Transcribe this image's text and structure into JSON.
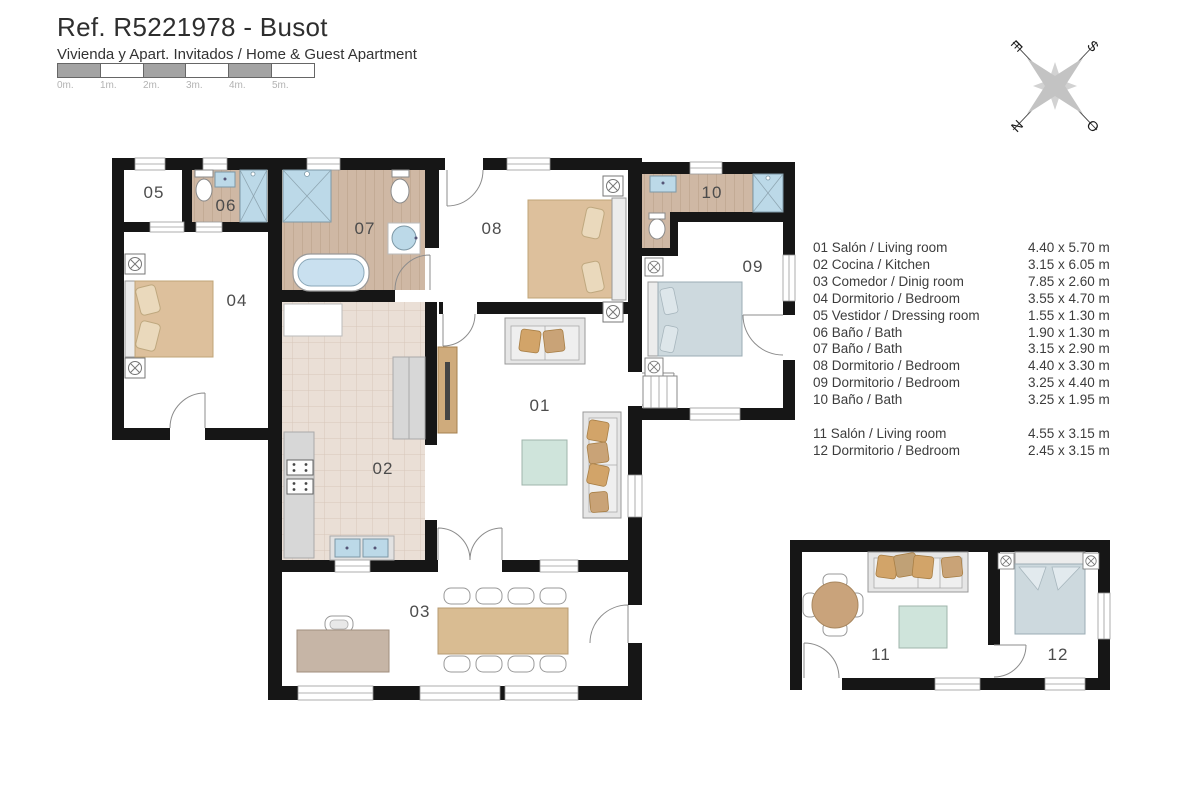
{
  "header": {
    "title": "Ref. R5221978 - Busot",
    "subtitle": "Vivienda y Apart. Invitados / Home & Guest Apartment"
  },
  "scale_bar": {
    "labels": [
      "0m.",
      "1m.",
      "2m.",
      "3m.",
      "4m.",
      "5m."
    ]
  },
  "compass": {
    "north": "N",
    "south": "S",
    "east": "E",
    "west": "O"
  },
  "legend": {
    "main_rows": [
      {
        "label": "01 Salón / Living room",
        "size": "4.40 x 5.70 m"
      },
      {
        "label": "02 Cocina / Kitchen",
        "size": "3.15 x 6.05 m"
      },
      {
        "label": "03 Comedor / Dinig room",
        "size": "7.85 x 2.60 m"
      },
      {
        "label": "04 Dormitorio / Bedroom",
        "size": "3.55 x 4.70 m"
      },
      {
        "label": "05 Vestidor / Dressing room",
        "size": "1.55 x 1.30 m"
      },
      {
        "label": "06 Baño / Bath",
        "size": "1.90 x 1.30 m"
      },
      {
        "label": "07 Baño / Bath",
        "size": "3.15 x 2.90 m"
      },
      {
        "label": "08 Dormitorio / Bedroom",
        "size": "4.40 x 3.30 m"
      },
      {
        "label": "09 Dormitorio / Bedroom",
        "size": "3.25 x 4.40 m"
      },
      {
        "label": "10 Baño / Bath",
        "size": "3.25 x 1.95 m"
      }
    ],
    "guest_rows": [
      {
        "label": "11 Salón / Living room",
        "size": "4.55 x 3.15 m"
      },
      {
        "label": "12 Dormitorio / Bedroom",
        "size": "2.45 x 3.15 m"
      }
    ]
  },
  "plan": {
    "room_labels": {
      "r01": "01",
      "r02": "02",
      "r03": "03",
      "r04": "04",
      "r05": "05",
      "r06": "06",
      "r07": "07",
      "r08": "08",
      "r09": "09",
      "r10": "10",
      "r11": "11",
      "r12": "12"
    }
  },
  "colors": {
    "wall": "#161616",
    "wood_floor": "#cfb8a4",
    "tile_floor": "#eadfd6",
    "water_blue": "#bcd9e8",
    "bed_tan": "#ddc09c",
    "bed_blue": "#cdd9de",
    "cushion_tan": "#d2a469",
    "table_green": "#cfe4db",
    "wood_furniture": "#cfab7c"
  }
}
